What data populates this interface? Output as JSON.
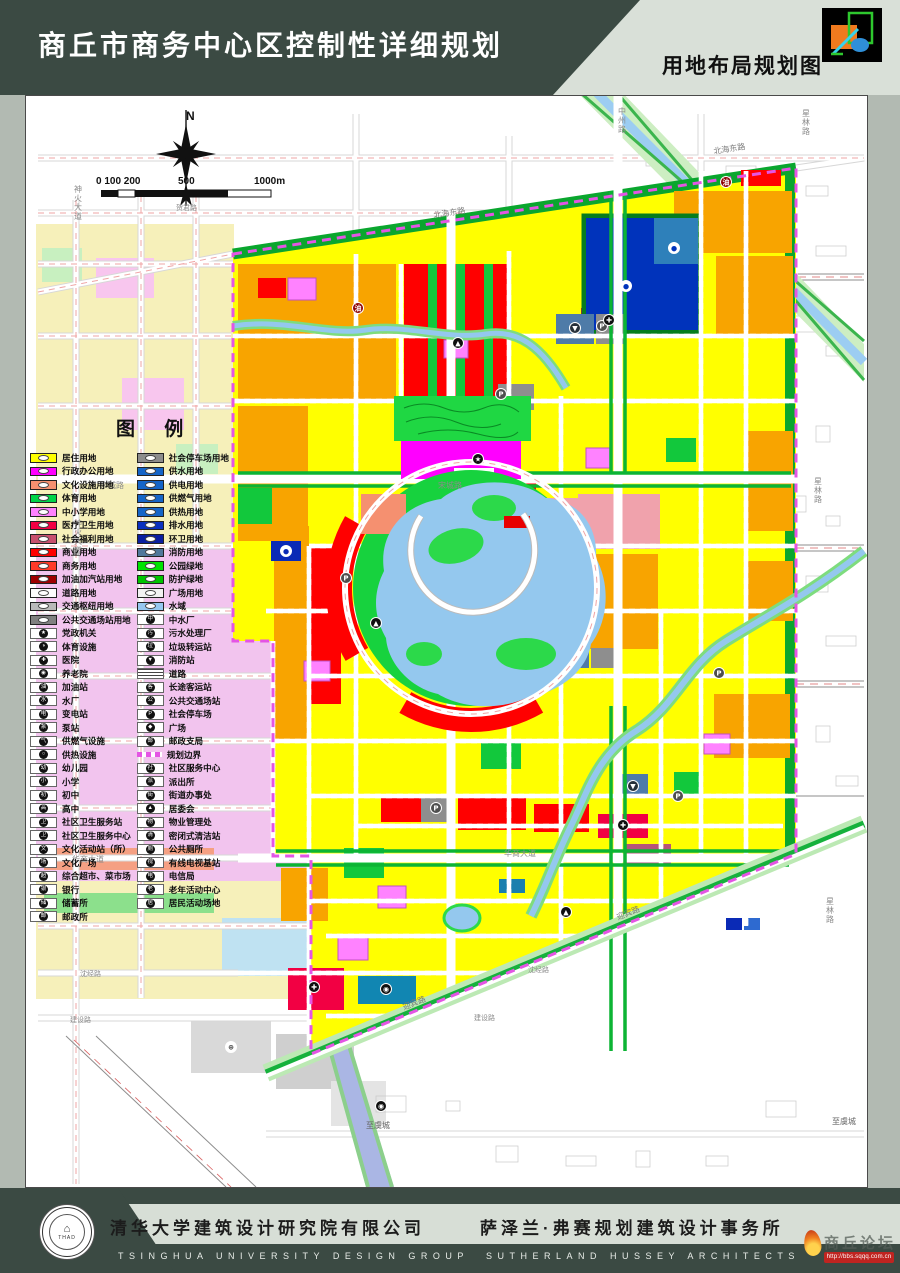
{
  "header": {
    "title": "商丘市商务中心区控制性详细规划",
    "map_label": "用地布局规划图"
  },
  "colors": {
    "banner_dark_green": "#3b4a43",
    "banner_light": "#d9e0d8",
    "residential_yellow": "#ffff00",
    "admin_magenta": "#ff00ff",
    "commercial_red": "#ff0000",
    "park_green": "#17d23e",
    "utility_blue": "#1565c8",
    "big_blue_parcel": "#0033bb",
    "water_blue": "#94c8ee",
    "boundary_magenta": "#e455e4",
    "orange_parcel": "#f8a400",
    "school_violet": "#ff82ff",
    "cream_outer": "#f6f0ba",
    "pink_zone": "#f2c4ee"
  },
  "map": {
    "north_label": "N",
    "legend_title": "图  例",
    "annotations": [
      {
        "t": "N",
        "x": 160,
        "y": 24,
        "s": 12,
        "c": "#111",
        "b": 1
      },
      {
        "t": "0 100 200",
        "x": 70,
        "y": 88,
        "s": 10,
        "c": "#111",
        "b": 1
      },
      {
        "t": "500",
        "x": 152,
        "y": 88,
        "s": 10,
        "c": "#111",
        "b": 1
      },
      {
        "t": "1000m",
        "x": 228,
        "y": 88,
        "s": 10,
        "c": "#111",
        "b": 1
      }
    ],
    "road_labels": [
      {
        "t": "神火大道",
        "x": 48,
        "y": 96,
        "s": 8,
        "c": "#8a8a8a",
        "v": 1
      },
      {
        "t": "神火大道",
        "x": 48,
        "y": 430,
        "s": 8,
        "c": "#8a8a8a",
        "v": 1
      },
      {
        "t": "贺君路",
        "x": 150,
        "y": 114,
        "s": 7,
        "c": "#8a8a8a"
      },
      {
        "t": "中州路",
        "x": 592,
        "y": 18,
        "s": 8,
        "c": "#8a8a8a",
        "v": 1
      },
      {
        "t": "北海东路",
        "x": 408,
        "y": 122,
        "s": 8,
        "c": "#7a7a7a",
        "r": -9
      },
      {
        "t": "北海东路",
        "x": 688,
        "y": 58,
        "s": 8,
        "c": "#7a7a7a",
        "r": -9
      },
      {
        "t": "星林路",
        "x": 776,
        "y": 20,
        "s": 8,
        "c": "#8a8a8a",
        "v": 1
      },
      {
        "t": "星林路",
        "x": 788,
        "y": 388,
        "s": 8,
        "c": "#8a8a8a",
        "v": 1
      },
      {
        "t": "星林路",
        "x": 800,
        "y": 808,
        "s": 8,
        "c": "#8a8a8a",
        "v": 1
      },
      {
        "t": "宋城路",
        "x": 412,
        "y": 392,
        "s": 8,
        "c": "#8a8a8a"
      },
      {
        "t": "宋城路",
        "x": 74,
        "y": 392,
        "s": 8,
        "c": "#8a8a8a"
      },
      {
        "t": "华商大道",
        "x": 46,
        "y": 766,
        "s": 8,
        "c": "#8a8a8a"
      },
      {
        "t": "华商大道",
        "x": 478,
        "y": 760,
        "s": 8,
        "c": "#8a8a8a"
      },
      {
        "t": "沈经路",
        "x": 54,
        "y": 880,
        "s": 7,
        "c": "#8a8a8a"
      },
      {
        "t": "沈经路",
        "x": 502,
        "y": 876,
        "s": 7,
        "c": "#8a8a8a"
      },
      {
        "t": "建设路",
        "x": 44,
        "y": 926,
        "s": 7,
        "c": "#8a8a8a"
      },
      {
        "t": "建设路",
        "x": 448,
        "y": 924,
        "s": 7,
        "c": "#8a8a8a"
      },
      {
        "t": "迎宾路",
        "x": 592,
        "y": 824,
        "s": 8,
        "c": "#7a7a7a",
        "r": -22
      },
      {
        "t": "迎宾路",
        "x": 378,
        "y": 914,
        "s": 8,
        "c": "#7a7a7a",
        "r": -22
      },
      {
        "t": "至虞城",
        "x": 340,
        "y": 1032,
        "s": 8,
        "c": "#666666"
      },
      {
        "t": "至虞城",
        "x": 806,
        "y": 1028,
        "s": 8,
        "c": "#666666"
      }
    ],
    "badges": [
      {
        "g": "P",
        "x": 475,
        "y": 298,
        "bg": "#4f4f4f"
      },
      {
        "g": "P",
        "x": 320,
        "y": 482,
        "bg": "#4f4f4f"
      },
      {
        "g": "P",
        "x": 576,
        "y": 230,
        "bg": "#4f4f4f"
      },
      {
        "g": "P",
        "x": 693,
        "y": 577,
        "bg": "#4f4f4f"
      },
      {
        "g": "P",
        "x": 410,
        "y": 712,
        "bg": "#4f4f4f"
      },
      {
        "g": "P",
        "x": 652,
        "y": 700,
        "bg": "#4f4f4f"
      },
      {
        "g": "✚",
        "x": 583,
        "y": 224,
        "bg": "#101010"
      },
      {
        "g": "✚",
        "x": 288,
        "y": 891,
        "bg": "#101010"
      },
      {
        "g": "✚",
        "x": 597,
        "y": 729,
        "bg": "#101010"
      },
      {
        "g": "▼",
        "x": 549,
        "y": 232,
        "bg": "#26303a"
      },
      {
        "g": "▼",
        "x": 607,
        "y": 690,
        "bg": "#26303a"
      },
      {
        "g": "▲",
        "x": 350,
        "y": 527,
        "bg": "#101010"
      },
      {
        "g": "▲",
        "x": 540,
        "y": 816,
        "bg": "#101010"
      },
      {
        "g": "▲",
        "x": 432,
        "y": 247,
        "bg": "#101010"
      },
      {
        "g": "★",
        "x": 452,
        "y": 363,
        "bg": "#101010"
      },
      {
        "g": "油",
        "x": 332,
        "y": 212,
        "bg": "#8d0000"
      },
      {
        "g": "油",
        "x": 700,
        "y": 86,
        "bg": "#8d0000"
      },
      {
        "g": "●",
        "x": 600,
        "y": 190,
        "bg": "#ffffff",
        "fg": "#0033bb"
      },
      {
        "g": "●",
        "x": 648,
        "y": 152,
        "bg": "#ffffff",
        "fg": "#0033bb"
      },
      {
        "g": "●",
        "x": 260,
        "y": 455,
        "bg": "#ffffff",
        "fg": "#0a2ab6"
      },
      {
        "g": "◉",
        "x": 360,
        "y": 893,
        "bg": "#101010"
      },
      {
        "g": "⊕",
        "x": 205,
        "y": 951,
        "bg": "#ffffff",
        "fg": "#444444"
      },
      {
        "g": "◉",
        "x": 355,
        "y": 1010,
        "bg": "#101010"
      }
    ]
  },
  "legend": {
    "title": "图  例",
    "columns": [
      {
        "items": [
          {
            "type": "land",
            "label": "居住用地",
            "color": "#ffff00"
          },
          {
            "type": "land",
            "label": "行政办公用地",
            "color": "#ff00ff"
          },
          {
            "type": "land",
            "label": "文化设施用地",
            "color": "#f59070"
          },
          {
            "type": "land",
            "label": "体育用地",
            "color": "#00d448"
          },
          {
            "type": "land",
            "label": "中小学用地",
            "color": "#ff82ff"
          },
          {
            "type": "land",
            "label": "医疗卫生用地",
            "color": "#f20043"
          },
          {
            "type": "land",
            "label": "社会福利用地",
            "color": "#c8506e"
          },
          {
            "type": "land",
            "label": "商业用地",
            "color": "#ff0000"
          },
          {
            "type": "land",
            "label": "商务用地",
            "color": "#ff3a28"
          },
          {
            "type": "land",
            "label": "加油加汽站用地",
            "color": "#9e0000"
          },
          {
            "type": "land",
            "label": "道路用地",
            "color": "#fdfdfd"
          },
          {
            "type": "land",
            "label": "交通枢纽用地",
            "color": "#b9b9b9"
          },
          {
            "type": "land",
            "label": "公共交通场站用地",
            "color": "#808080"
          },
          {
            "type": "fac",
            "label": "党政机关",
            "glyph": "★"
          },
          {
            "type": "fac",
            "label": "体育设施",
            "glyph": "◑"
          },
          {
            "type": "fac",
            "label": "医院",
            "glyph": "✚"
          },
          {
            "type": "fac",
            "label": "养老院",
            "glyph": "◉"
          },
          {
            "type": "fac",
            "label": "加油站",
            "glyph": "油"
          },
          {
            "type": "fac",
            "label": "水厂",
            "glyph": "水"
          },
          {
            "type": "fac",
            "label": "变电站",
            "glyph": "电"
          },
          {
            "type": "fac",
            "label": "泵站",
            "glyph": "泵"
          },
          {
            "type": "fac",
            "label": "供燃气设施",
            "glyph": "气"
          },
          {
            "type": "fac",
            "label": "供热设施",
            "glyph": "○"
          },
          {
            "type": "fac",
            "label": "幼儿园",
            "glyph": "幼"
          },
          {
            "type": "fac",
            "label": "小学",
            "glyph": "小"
          },
          {
            "type": "fac",
            "label": "初中",
            "glyph": "初"
          },
          {
            "type": "fac",
            "label": "高中",
            "glyph": "高"
          },
          {
            "type": "fac",
            "label": "社区卫生服务站",
            "glyph": "卫"
          },
          {
            "type": "fac",
            "label": "社区卫生服务中心",
            "glyph": "卫"
          },
          {
            "type": "fac",
            "label": "文化活动站（所）",
            "glyph": "文"
          },
          {
            "type": "fac",
            "label": "文化广场",
            "glyph": "场"
          },
          {
            "type": "fac",
            "label": "综合超市、菜市场",
            "glyph": "超"
          },
          {
            "type": "fac",
            "label": "银行",
            "glyph": "银"
          },
          {
            "type": "fac",
            "label": "储蓄所",
            "glyph": "储"
          },
          {
            "type": "fac",
            "label": "邮政所",
            "glyph": "邮"
          }
        ]
      },
      {
        "items": [
          {
            "type": "land",
            "label": "社会停车场用地",
            "color": "#8c8c8c"
          },
          {
            "type": "land",
            "label": "供水用地",
            "color": "#1565c8"
          },
          {
            "type": "land",
            "label": "供电用地",
            "color": "#1565c8"
          },
          {
            "type": "land",
            "label": "供燃气用地",
            "color": "#1565c8"
          },
          {
            "type": "land",
            "label": "供热用地",
            "color": "#1565c8"
          },
          {
            "type": "land",
            "label": "排水用地",
            "color": "#0a30c0"
          },
          {
            "type": "land",
            "label": "环卫用地",
            "color": "#0a1ea0"
          },
          {
            "type": "land",
            "label": "消防用地",
            "color": "#50789b"
          },
          {
            "type": "land",
            "label": "公园绿地",
            "color": "#00e400"
          },
          {
            "type": "land",
            "label": "防护绿地",
            "color": "#00c400"
          },
          {
            "type": "land",
            "label": "广场用地",
            "color": "#f2f2f2"
          },
          {
            "type": "land",
            "label": "水域",
            "color": "#96c8f0"
          },
          {
            "type": "fac",
            "label": "中水厂",
            "glyph": "中"
          },
          {
            "type": "fac",
            "label": "污水处理厂",
            "glyph": "污"
          },
          {
            "type": "fac",
            "label": "垃圾转运站",
            "glyph": "垃"
          },
          {
            "type": "fac",
            "label": "消防站",
            "glyph": "▼"
          },
          {
            "type": "road",
            "label": "道路"
          },
          {
            "type": "fac",
            "label": "长途客运站",
            "glyph": "客"
          },
          {
            "type": "fac",
            "label": "公共交通场站",
            "glyph": "公"
          },
          {
            "type": "fac",
            "label": "社会停车场",
            "glyph": "P"
          },
          {
            "type": "fac",
            "label": "广场",
            "glyph": "◆"
          },
          {
            "type": "fac",
            "label": "邮政支局",
            "glyph": "邮"
          },
          {
            "type": "boundary",
            "label": "规划边界"
          },
          {
            "type": "fac",
            "label": "社区服务中心",
            "glyph": "社"
          },
          {
            "type": "fac",
            "label": "派出所",
            "glyph": "派"
          },
          {
            "type": "fac",
            "label": "街道办事处",
            "glyph": "街"
          },
          {
            "type": "fac",
            "label": "居委会",
            "glyph": "▲"
          },
          {
            "type": "fac",
            "label": "物业管理处",
            "glyph": "物"
          },
          {
            "type": "fac",
            "label": "密闭式清洁站",
            "glyph": "清"
          },
          {
            "type": "fac",
            "label": "公共厕所",
            "glyph": "厕"
          },
          {
            "type": "fac",
            "label": "有线电视基站",
            "glyph": "视"
          },
          {
            "type": "fac",
            "label": "电信局",
            "glyph": "电"
          },
          {
            "type": "fac",
            "label": "老年活动中心",
            "glyph": "老"
          },
          {
            "type": "fac",
            "label": "居民活动场地",
            "glyph": "居"
          }
        ]
      }
    ]
  },
  "footer": {
    "company_cn_1": "清华大学建筑设计研究院有限公司",
    "company_cn_2": "萨泽兰·弗赛规划建筑设计事务所",
    "company_en_1": "TSINGHUA UNIVERSITY DESIGN GROUP",
    "company_en_2": "SUTHERLAND HUSSEY ARCHITECTS",
    "seal_text": "THAD",
    "watermark_name": "商丘论坛",
    "watermark_url": "http://bbs.sqqq.com.cn"
  }
}
